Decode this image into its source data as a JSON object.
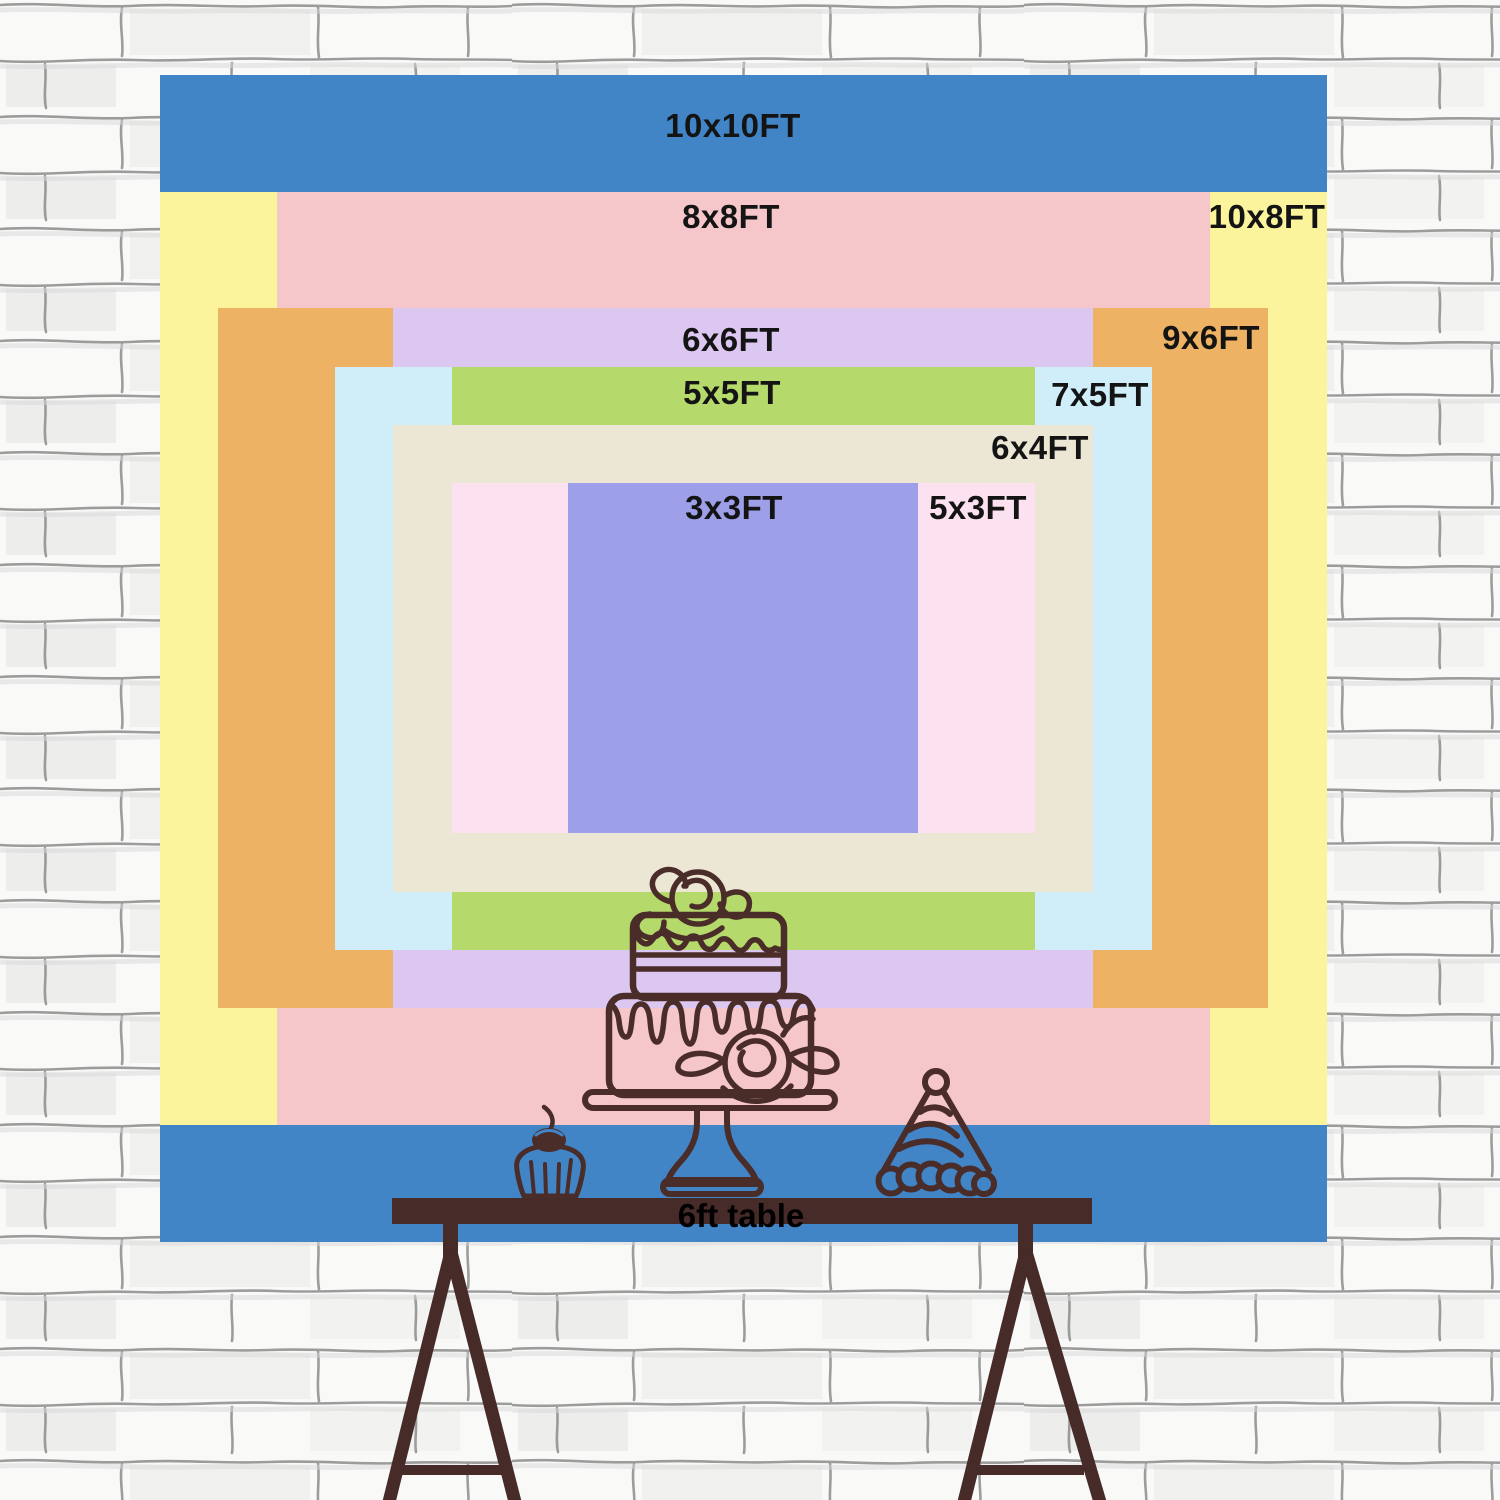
{
  "title": "Backdrop size chart",
  "backdrop": {
    "unit": "FT",
    "layers": [
      {
        "id": "10x10",
        "label": "10x10FT",
        "width_ft": 10,
        "height_ft": 10,
        "color": "#4185c7"
      },
      {
        "id": "10x8",
        "label": "10x8FT",
        "width_ft": 10,
        "height_ft": 8,
        "color": "#fbf49c"
      },
      {
        "id": "8x8",
        "label": "8x8FT",
        "width_ft": 8,
        "height_ft": 8,
        "color": "#f5c7ca"
      },
      {
        "id": "9x6",
        "label": "9x6FT",
        "width_ft": 9,
        "height_ft": 6,
        "color": "#edb264"
      },
      {
        "id": "6x6",
        "label": "6x6FT",
        "width_ft": 6,
        "height_ft": 6,
        "color": "#dcc7f1"
      },
      {
        "id": "7x5",
        "label": "7x5FT",
        "width_ft": 7,
        "height_ft": 5,
        "color": "#cfeefa"
      },
      {
        "id": "5x5",
        "label": "5x5FT",
        "width_ft": 5,
        "height_ft": 5,
        "color": "#b5da6b"
      },
      {
        "id": "6x4",
        "label": "6x4FT",
        "width_ft": 6,
        "height_ft": 4,
        "color": "#ece6d4"
      },
      {
        "id": "5x3",
        "label": "5x3FT",
        "width_ft": 5,
        "height_ft": 3,
        "color": "#fce2f0"
      },
      {
        "id": "3x3",
        "label": "3x3FT",
        "width_ft": 3,
        "height_ft": 3,
        "color": "#9da0e8"
      }
    ]
  },
  "table": {
    "label": "6ft table",
    "color": "#472b28"
  },
  "art": {
    "line_color": "#4a2c29"
  },
  "wall": {
    "background": "#f9f9f8",
    "mortar": "#8c8c8c"
  }
}
